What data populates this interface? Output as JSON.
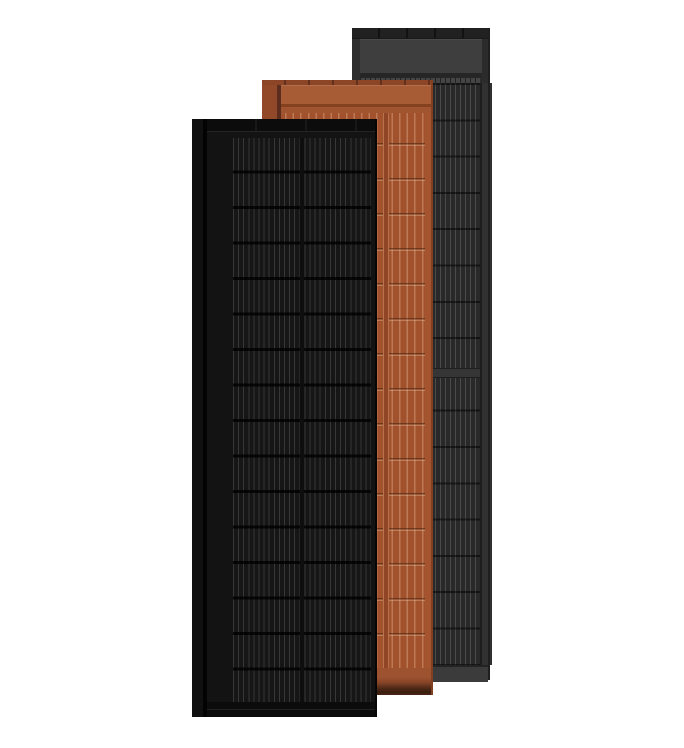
{
  "scene": {
    "background_color": "#ffffff",
    "panel_count": 3
  },
  "panels": {
    "slate_gray": {
      "finish": "slate gray",
      "frame_color": "#2b2b2b",
      "rail_color": "#2e2e2e",
      "top_frame_color": "#212121",
      "header_color": "#3e3e3e",
      "cell_field_color": "#292929",
      "cell_line_color": "#4b4b4b",
      "section_divider_color": "#353535",
      "footer_color": "#3b3b3b",
      "right_margin_color": "#313131",
      "cell_rows": 16,
      "cell_strips_per_row": 24
    },
    "terracotta": {
      "finish": "terracotta",
      "frame_color": "#a1522c",
      "rail_color": "#91492a",
      "top_frame_color": "#8c4526",
      "header_color": "#a85c36",
      "cell_field_color": "#a1522c",
      "cell_line_color": "#bf7c55",
      "row_line_color": "#7b3c1f",
      "footer_gradient_top": "#9d5230",
      "footer_gradient_bottom": "#3a1d0e",
      "right_margin_color": "#a4552f",
      "cell_rows": 16,
      "cell_strips_per_row": 18,
      "cell_column_groups": 2
    },
    "matte_black": {
      "finish": "matte black",
      "frame_color": "#131313",
      "rail_color": "#101010",
      "top_frame_color": "#0c0c0c",
      "cell_field_color": "#161616",
      "cell_line_color": "#3a3a3a",
      "row_gap_color": "#050505",
      "column_divider_color": "#0e0e0e",
      "footer_color": "#0d0d0d",
      "cell_rows": 16,
      "cell_strips_per_row": 26,
      "cell_column_groups": 2
    }
  }
}
